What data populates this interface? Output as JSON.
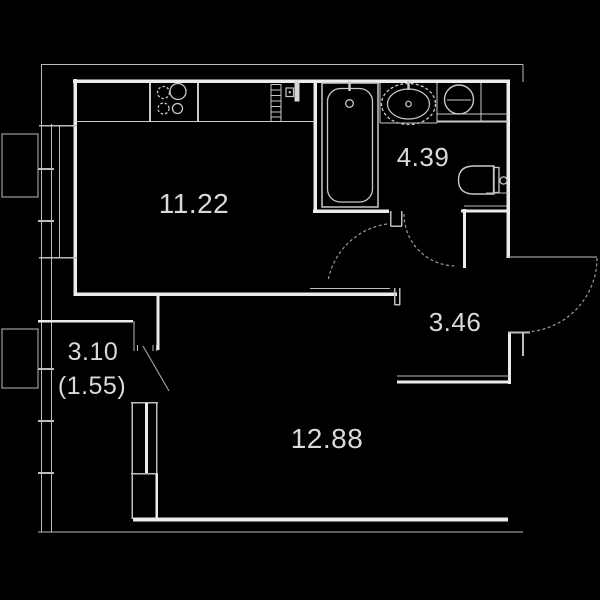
{
  "plan": {
    "title": "studio-apartment-floor-plan",
    "colors": {
      "background": "#000000",
      "wall": "#ececec",
      "hairline": "#bdbdbd",
      "fixture": "#c9c9c9",
      "arc": "#9a9a9a",
      "label": "#d9d9d9"
    },
    "rooms": [
      {
        "name": "kitchen",
        "area_label": "11.22"
      },
      {
        "name": "bathroom",
        "area_label": "4.39"
      },
      {
        "name": "hallway",
        "area_label": "3.46"
      },
      {
        "name": "living-room",
        "area_label": "12.88"
      },
      {
        "name": "balcony",
        "area_label": "3.10",
        "area_label_reduced": "(1.55)"
      }
    ],
    "fixtures": [
      "stove-icon",
      "radiator-icon",
      "electric-panel-icon",
      "vent-stub-icon",
      "bathtub-icon",
      "sink-icon",
      "washing-machine-icon",
      "toilet-icon",
      "window-icon",
      "balcony-glazing-icon",
      "ac-unit-box-icon",
      "door-arc-icon",
      "entrance-door-arc-icon",
      "balcony-door-sash-icon"
    ]
  }
}
